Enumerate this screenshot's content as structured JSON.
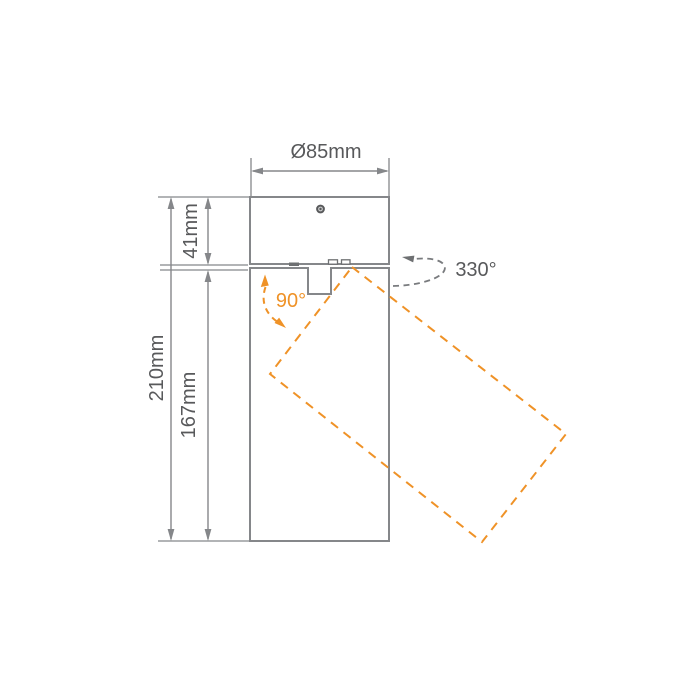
{
  "diagram": {
    "type": "product-dimension-drawing",
    "subject": "surface-mounted adjustable spotlight, side elevation",
    "dimensions": {
      "diameter_label": "Ø85mm",
      "canopy_height_label": "41mm",
      "overall_height_label": "210mm",
      "body_height_label": "167mm"
    },
    "angles": {
      "tilt_label": "90°",
      "rotation_label": "330°"
    },
    "colors": {
      "line_gray": "#85878A",
      "dark_gray": "#6E7072",
      "text_gray": "#58595B",
      "accent_orange": "#EF9227",
      "background": "#FFFFFF"
    }
  }
}
